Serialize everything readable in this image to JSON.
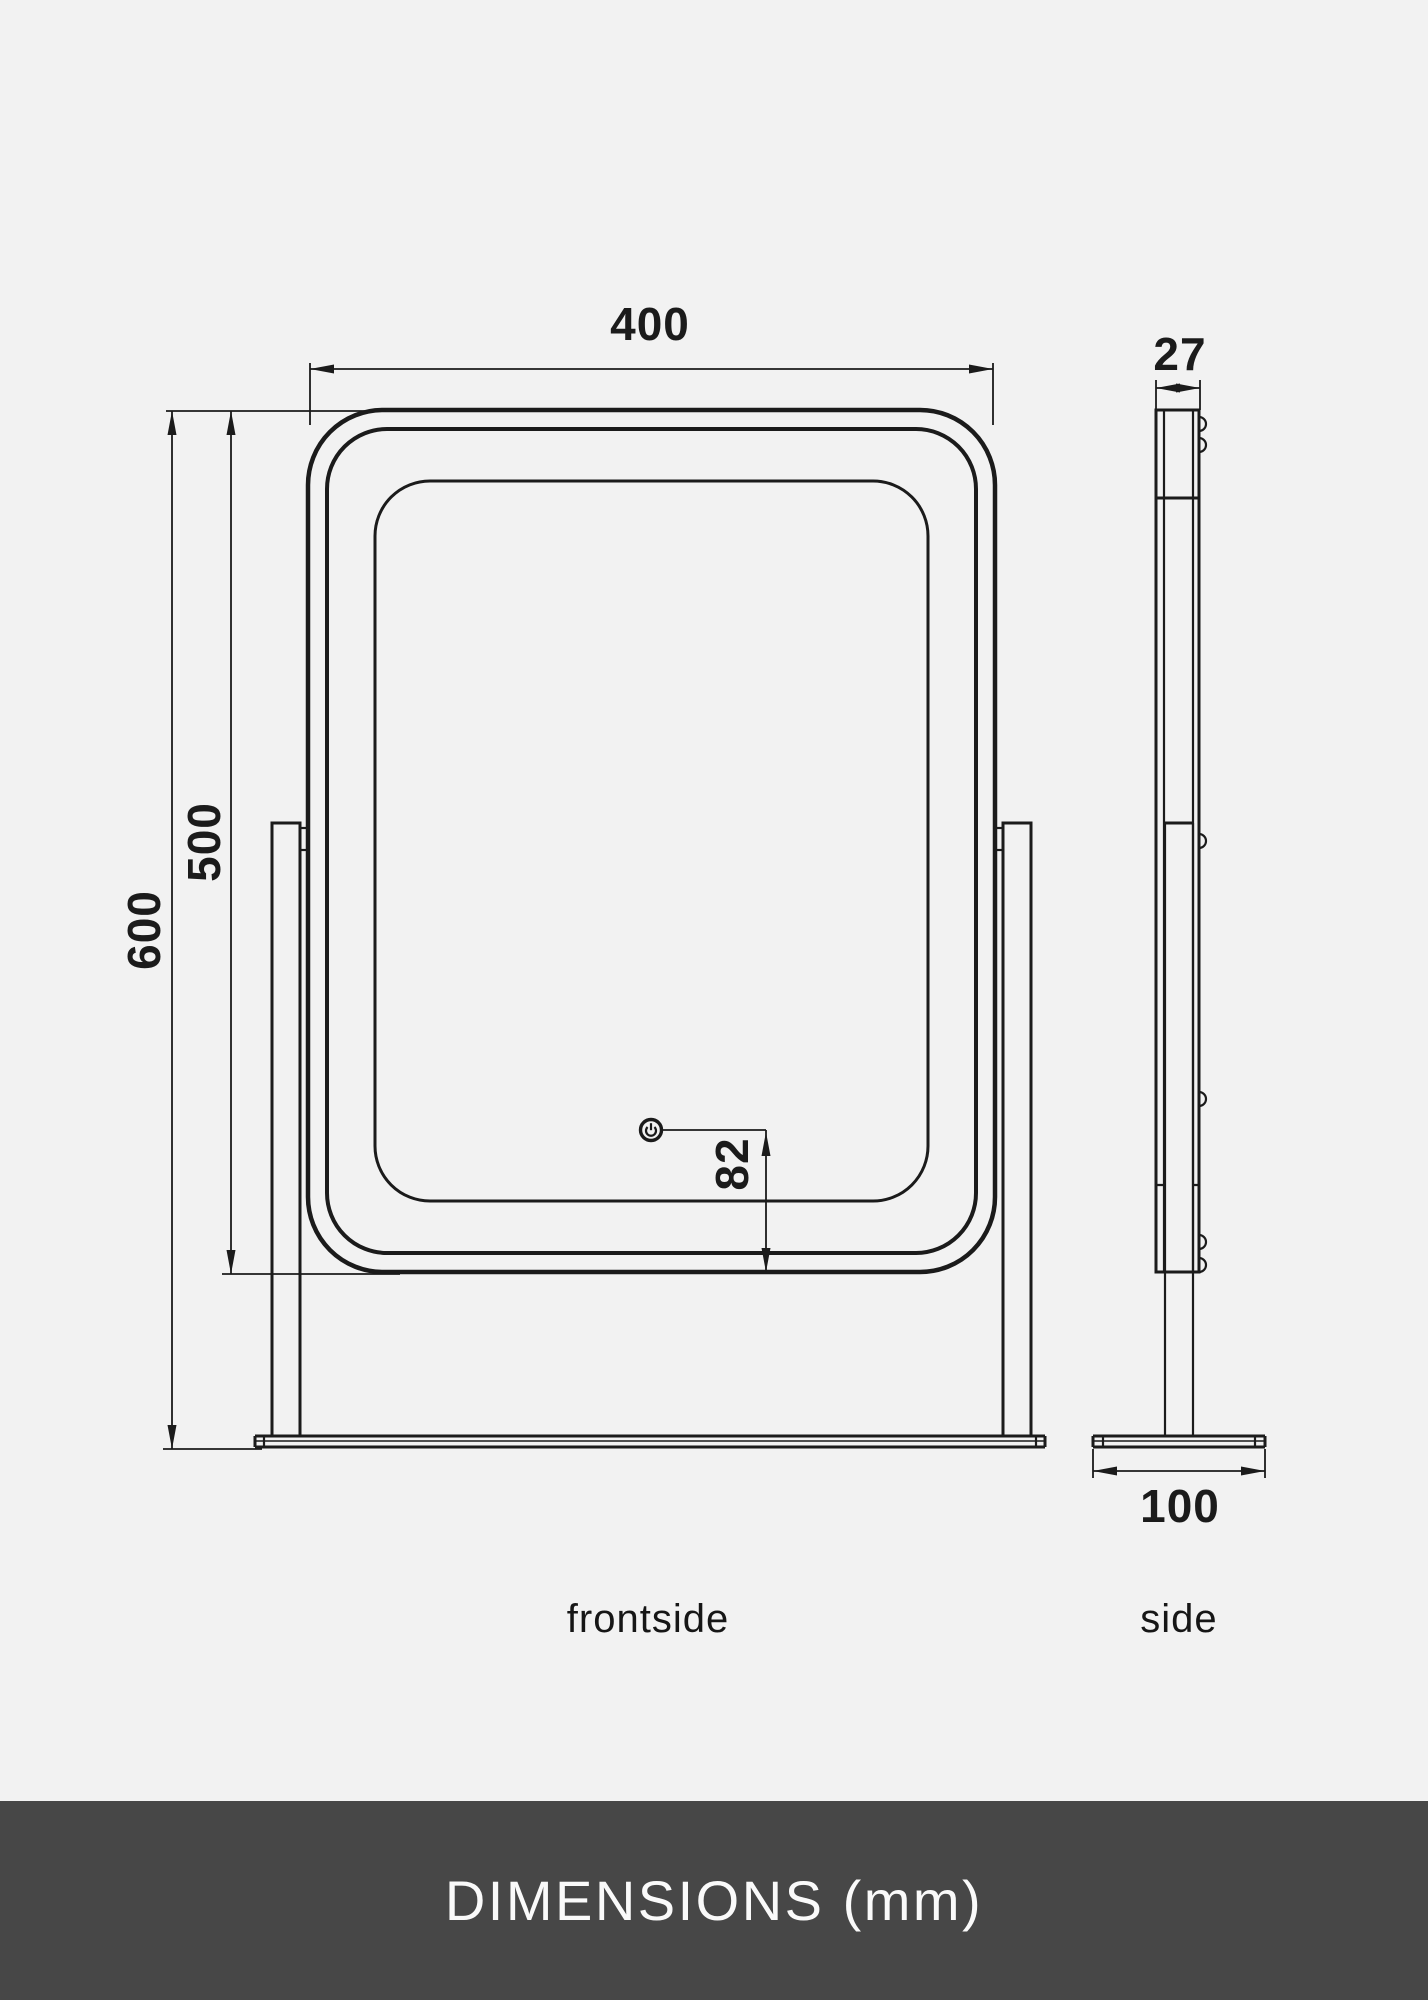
{
  "page": {
    "background_color": "#f2f2f2",
    "line_color": "#1b1b1b"
  },
  "views": {
    "front": {
      "label": "frontside",
      "dims": {
        "width": "400",
        "height_total": "600",
        "height_mirror": "500",
        "button_to_bottom": "82"
      }
    },
    "side": {
      "label": "side",
      "dims": {
        "thickness": "27",
        "base_depth": "100"
      }
    }
  },
  "icons": {
    "power_button": "power-icon"
  },
  "footer": {
    "text": "DIMENSIONS (mm)",
    "background": "#474747",
    "text_color": "#fafafa"
  }
}
